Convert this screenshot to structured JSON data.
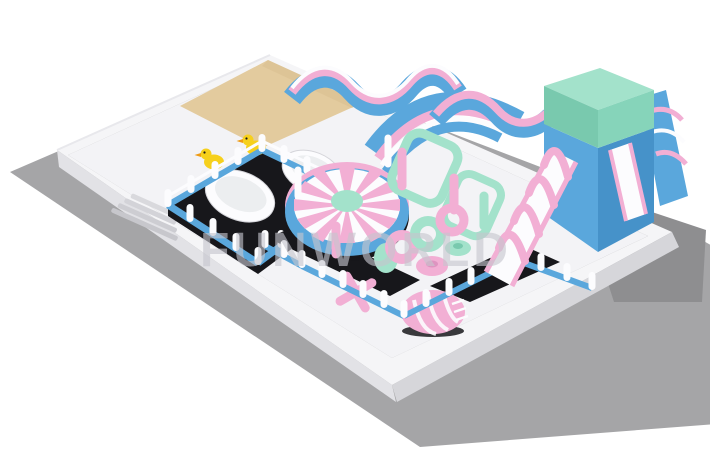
{
  "scene": {
    "watermark": "FUNWORLD",
    "objects": [
      "ground-platform",
      "boundary-wall",
      "sand-pit",
      "entry-steps",
      "duck-pen",
      "rubber-duck",
      "ball-tub",
      "pen-railing",
      "carousel-ring",
      "rainbow-slide",
      "wavy-obstacle",
      "arch-obstacle",
      "pole-obstacle",
      "donut-obstacles",
      "jack-toy",
      "striped-dome",
      "play-fence",
      "main-slide-tower",
      "slide-lane",
      "pink-arches",
      "side-slide"
    ]
  },
  "palette": {
    "background": "#ffffff",
    "ground": "#a5a5a7",
    "groundShadow": "#8e8e90",
    "wallWhite": "#f5f5f7",
    "wallShade": "#e2e2e6",
    "wallDark": "#d6d6da",
    "floor": "#f3f3f6",
    "dark": "#17171b",
    "blue": "#5aa7dc",
    "blueDark": "#4692c9",
    "pink": "#f2afd4",
    "pinkDark": "#de94c0",
    "mint": "#a3e2cb",
    "mintDark": "#86d4ba",
    "mintDeep": "#79c9ae",
    "sand": "#e3cb9e",
    "duckYellow": "#f6d01c",
    "duckOrange": "#ef9b13",
    "white": "#fcfcfe",
    "watermark": "#c6c6ce"
  }
}
